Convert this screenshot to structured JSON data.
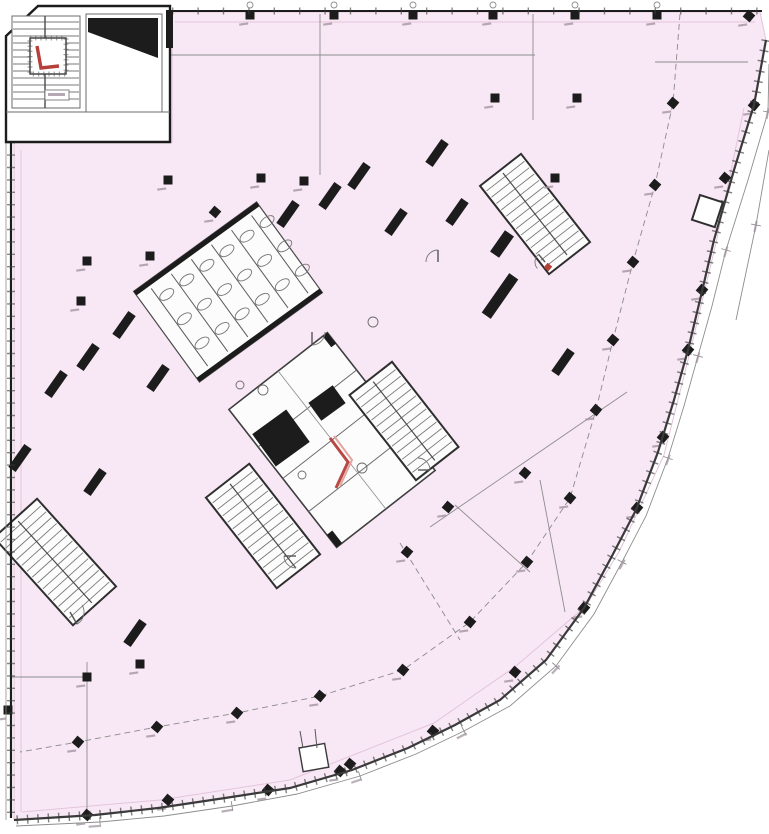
{
  "meta": {
    "drawing_type": "architectural floor plan",
    "notes": "CAD plan of a building storey: large tinted floor plate with curved south-east facade, rotated central service core, perimeter dimension lines. Dimension micro-text in source is illegible (rendered as smudge marks, no text content)."
  },
  "palette": {
    "floor_fill": "#f8e8f5",
    "floor_inner_line": "#e3c4dc",
    "wall": "#1c1c1c",
    "wall_soft": "#3a3a3a",
    "thin_line": "#8d8d8d",
    "dash_line": "#8a8a8a",
    "tread": "#7a7a7a",
    "room_fill": "#fdfcfd",
    "red": "#b5403a",
    "red_soft": "#e2a5a0",
    "smudge": "#a394a0",
    "white": "#ffffff"
  },
  "floor": {
    "outline": [
      [
        172,
        12
      ],
      [
        760,
        12
      ],
      [
        766,
        40
      ],
      [
        754,
        105
      ],
      [
        734,
        170
      ],
      [
        714,
        240
      ],
      [
        700,
        300
      ],
      [
        688,
        350
      ],
      [
        674,
        400
      ],
      [
        658,
        452
      ],
      [
        636,
        510
      ],
      [
        612,
        556
      ],
      [
        584,
        608
      ],
      [
        546,
        660
      ],
      [
        500,
        700
      ],
      [
        455,
        725
      ],
      [
        408,
        748
      ],
      [
        352,
        770
      ],
      [
        290,
        788
      ],
      [
        225,
        798
      ],
      [
        158,
        808
      ],
      [
        95,
        815
      ],
      [
        14,
        820
      ],
      [
        14,
        142
      ],
      [
        172,
        142
      ]
    ],
    "curve_start_index": 2,
    "inner_offset_line": [
      [
        744,
        108
      ],
      [
        716,
        243
      ],
      [
        690,
        352
      ],
      [
        664,
        455
      ],
      [
        620,
        550
      ],
      [
        586,
        606
      ],
      [
        516,
        666
      ],
      [
        434,
        723
      ],
      [
        290,
        780
      ],
      [
        160,
        800
      ],
      [
        22,
        812
      ]
    ],
    "top_inner_line": [
      [
        175,
        22
      ],
      [
        755,
        22
      ]
    ],
    "left_inner_line": [
      [
        21,
        150
      ],
      [
        21,
        812
      ]
    ]
  },
  "columns": {
    "size": 9,
    "plain": [
      [
        250,
        15
      ],
      [
        334,
        15
      ],
      [
        413,
        15
      ],
      [
        493,
        15
      ],
      [
        575,
        15
      ],
      [
        657,
        15
      ],
      [
        495,
        98
      ],
      [
        577,
        98
      ],
      [
        168,
        180
      ],
      [
        261,
        178
      ],
      [
        304,
        181
      ],
      [
        555,
        178
      ],
      [
        87,
        261
      ],
      [
        150,
        256
      ],
      [
        81,
        301
      ],
      [
        87,
        677
      ],
      [
        140,
        664
      ],
      [
        8,
        710
      ]
    ],
    "tilted_edge": [
      [
        749,
        16
      ],
      [
        754,
        105
      ],
      [
        725,
        178
      ],
      [
        702,
        290
      ],
      [
        688,
        350
      ],
      [
        663,
        437
      ],
      [
        637,
        508
      ],
      [
        584,
        608
      ],
      [
        515,
        672
      ],
      [
        433,
        731
      ],
      [
        350,
        764
      ],
      [
        340,
        771
      ],
      [
        268,
        790
      ],
      [
        168,
        800
      ],
      [
        87,
        815
      ]
    ],
    "tilted_grid": [
      [
        673,
        103
      ],
      [
        655,
        185
      ],
      [
        633,
        262
      ],
      [
        613,
        340
      ],
      [
        596,
        410
      ],
      [
        570,
        498
      ],
      [
        527,
        562
      ],
      [
        470,
        622
      ],
      [
        403,
        670
      ],
      [
        320,
        696
      ],
      [
        237,
        713
      ],
      [
        157,
        727
      ],
      [
        78,
        742
      ],
      [
        525,
        473
      ],
      [
        448,
        507
      ],
      [
        407,
        552
      ],
      [
        215,
        212
      ]
    ]
  },
  "wall_stubs": {
    "w": 28,
    "h": 9,
    "rot": -55,
    "items": [
      [
        288,
        214
      ],
      [
        330,
        196
      ],
      [
        359,
        176
      ],
      [
        437,
        153
      ],
      [
        396,
        222
      ],
      [
        457,
        212
      ],
      [
        124,
        325
      ],
      [
        88,
        357
      ],
      [
        56,
        384
      ],
      [
        158,
        378
      ],
      [
        20,
        458
      ],
      [
        95,
        482
      ],
      [
        135,
        633
      ],
      [
        563,
        362
      ]
    ],
    "big_items": [
      [
        500,
        296,
        48
      ],
      [
        502,
        244,
        26
      ]
    ]
  },
  "stairs": [
    {
      "cx": 535,
      "cy": 214,
      "w": 112,
      "h": 52,
      "rot": 52,
      "n": 14
    },
    {
      "cx": 263,
      "cy": 526,
      "w": 115,
      "h": 55,
      "rot": 52,
      "n": 14
    },
    {
      "cx": 55,
      "cy": 562,
      "w": 118,
      "h": 58,
      "rot": 48,
      "n": 15
    },
    {
      "cx": 404,
      "cy": 421,
      "w": 108,
      "h": 54,
      "rot": 52,
      "n": 13
    }
  ],
  "bike_room": {
    "cx": 228,
    "cy": 292,
    "w": 152,
    "h": 112,
    "rot": -36,
    "stalls": 6
  },
  "core_block": {
    "cx": 332,
    "cy": 440,
    "w": 175,
    "h": 125,
    "rot": 52
  },
  "shafts": [
    {
      "cx": 281,
      "cy": 438,
      "w": 42,
      "h": 40,
      "rot": -36
    },
    {
      "cx": 327,
      "cy": 403,
      "w": 30,
      "h": 22,
      "rot": -36
    }
  ],
  "red_marks": {
    "core_polyline": [
      [
        330,
        438
      ],
      [
        348,
        462
      ],
      [
        336,
        488
      ]
    ],
    "small_square": [
      548,
      267
    ],
    "stair_block_path": [
      [
        37,
        46
      ],
      [
        41,
        68
      ],
      [
        59,
        66
      ]
    ]
  },
  "dashed_lines": [
    [
      [
        680,
        14
      ],
      [
        673,
        103
      ],
      [
        655,
        185
      ],
      [
        633,
        262
      ],
      [
        613,
        340
      ],
      [
        596,
        410
      ],
      [
        570,
        498
      ],
      [
        527,
        562
      ],
      [
        470,
        622
      ],
      [
        403,
        670
      ],
      [
        320,
        696
      ],
      [
        237,
        713
      ],
      [
        157,
        727
      ],
      [
        78,
        742
      ],
      [
        20,
        752
      ]
    ],
    [
      [
        400,
        543
      ],
      [
        460,
        640
      ]
    ]
  ],
  "thin_lines": [
    [
      155,
      55,
      535,
      55
    ],
    [
      320,
      14,
      320,
      175
    ],
    [
      533,
      14,
      533,
      120
    ],
    [
      655,
      62,
      748,
      62
    ],
    [
      627,
      392,
      430,
      527
    ],
    [
      455,
      505,
      530,
      572
    ],
    [
      540,
      480,
      565,
      612
    ],
    [
      12,
      677,
      87,
      677
    ],
    [
      87,
      662,
      87,
      815
    ]
  ],
  "outer_dim_path": [
    [
      769,
      64
    ],
    [
      768,
      112
    ],
    [
      748,
      180
    ],
    [
      726,
      250
    ],
    [
      712,
      306
    ],
    [
      698,
      356
    ],
    [
      684,
      406
    ],
    [
      668,
      458
    ],
    [
      646,
      516
    ],
    [
      622,
      562
    ],
    [
      594,
      614
    ],
    [
      556,
      666
    ],
    [
      510,
      706
    ],
    [
      464,
      731
    ],
    [
      416,
      754
    ],
    [
      360,
      776
    ],
    [
      297,
      794
    ],
    [
      232,
      806
    ],
    [
      164,
      816
    ],
    [
      100,
      822
    ],
    [
      16,
      826
    ]
  ],
  "outer_dim_path2": [
    [
      769,
      150
    ],
    [
      756,
      225
    ],
    [
      736,
      320
    ]
  ],
  "door_arcs": [
    [
      312,
      332,
      13,
      0
    ],
    [
      438,
      262,
      12,
      180
    ],
    [
      296,
      556,
      12,
      90
    ],
    [
      418,
      470,
      12,
      -90
    ],
    [
      48,
      118,
      14,
      90
    ],
    [
      98,
      122,
      15,
      90
    ],
    [
      150,
      120,
      13,
      90
    ],
    [
      70,
      612,
      14,
      -30
    ],
    [
      545,
      262,
      10,
      140
    ]
  ],
  "fixture_circles": [
    [
      373,
      322,
      5
    ],
    [
      263,
      390,
      5
    ],
    [
      362,
      468,
      5
    ],
    [
      302,
      475,
      4
    ],
    [
      240,
      385,
      4
    ]
  ],
  "top_wall_markers": {
    "y": 5,
    "r": 3,
    "xs": [
      250,
      334,
      413,
      493,
      575,
      657
    ]
  },
  "facade_box": {
    "x": 299,
    "y": 748,
    "w": 26,
    "h": 24,
    "antennas": [
      [
        303,
        748,
        300,
        731
      ],
      [
        317,
        748,
        315,
        729
      ]
    ]
  },
  "edge_service_box": {
    "x": 700,
    "y": 195,
    "w": 24,
    "h": 26
  }
}
